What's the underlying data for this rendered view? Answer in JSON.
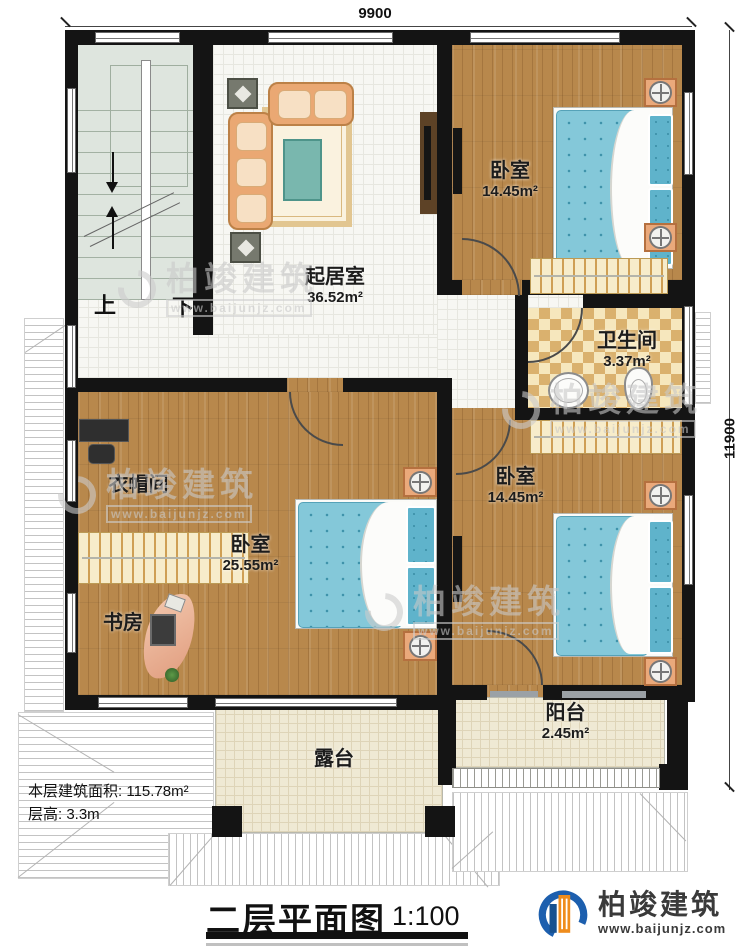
{
  "dimensions": {
    "top": "9900",
    "right": "11900"
  },
  "stairs": {
    "up": "上",
    "down": "下"
  },
  "rooms": [
    {
      "name": "起居室",
      "area": "36.52m²"
    },
    {
      "name": "卧室",
      "area": "14.45m²"
    },
    {
      "name": "卫生间",
      "area": "3.37m²"
    },
    {
      "name": "衣帽间",
      "area": ""
    },
    {
      "name": "卧室",
      "area": "25.55m²"
    },
    {
      "name": "书房",
      "area": ""
    },
    {
      "name": "卧室",
      "area": "14.45m²"
    },
    {
      "name": "阳台",
      "area": "2.45m²"
    },
    {
      "name": "露台",
      "area": ""
    }
  ],
  "info": {
    "line1": "本层建筑面积: 115.78m²",
    "line2": "层高: 3.3m"
  },
  "title": {
    "text": "二层平面图",
    "scale": "1:100"
  },
  "brand": {
    "name": "柏竣建筑",
    "url": "www.baijunjz.com"
  },
  "watermark": {
    "name": "柏竣建筑",
    "url": "www.baijunjz.com"
  },
  "colors": {
    "wall": "#141414",
    "wood": "#b8884c",
    "tile": "#f7f7f3",
    "stair": "#dee5de",
    "bath_tile": "#dab16e",
    "terrace": "#efe9d4",
    "bed": "#84c8d9",
    "sofa": "#eaa873",
    "brand_blue": "#1d5fae",
    "brand_orange": "#ef8c1c"
  }
}
